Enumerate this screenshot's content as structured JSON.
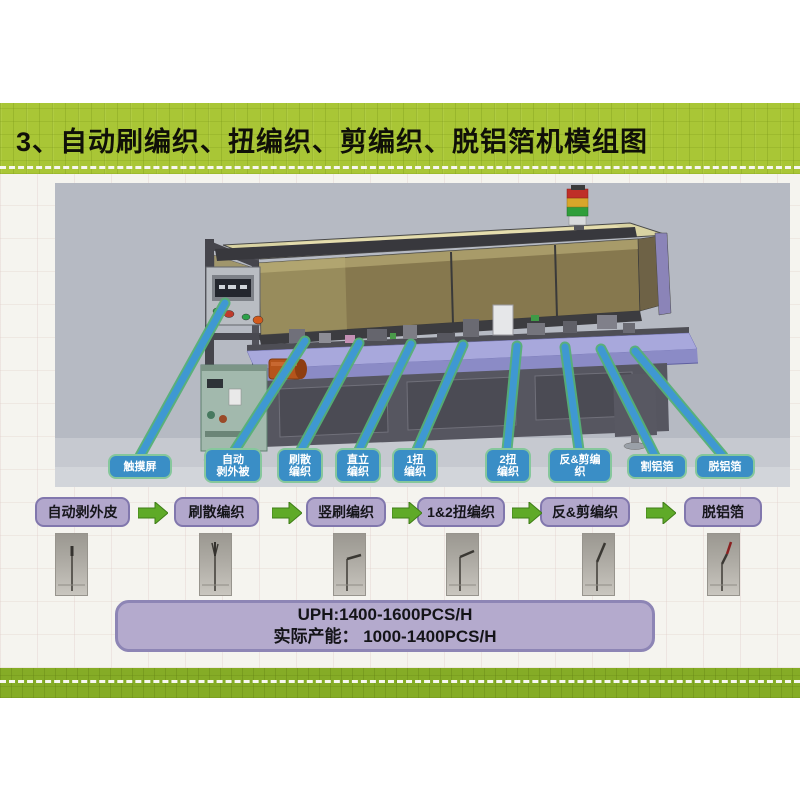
{
  "slide": {
    "title": "3、自动刷编织、扭编织、剪编织、脱铝箔机模组图",
    "colors": {
      "title_bar_green": "#a9c636",
      "footer_band_green": "#85ac26",
      "callout_blue": "#3a8ec6",
      "callout_border_green": "#86c79c",
      "flow_box_purple": "#b2a7cc",
      "flow_box_border": "#8177ad",
      "arrow_green": "#5faa28",
      "capacity_box_purple": "#b4aacd",
      "machine_bg_gray": "#b6bac3"
    }
  },
  "figure": {
    "description": "3D CAD render of automatic braid brushing, twisting, cutting and aluminum-foil stripping machine",
    "callouts": [
      {
        "lines": [
          "触摸屏"
        ]
      },
      {
        "lines": [
          "自动",
          "剥外被"
        ]
      },
      {
        "lines": [
          "刷散",
          "编织"
        ]
      },
      {
        "lines": [
          "直立",
          "编织"
        ]
      },
      {
        "lines": [
          "1扭",
          "编织"
        ]
      },
      {
        "lines": [
          "2扭",
          "编织"
        ]
      },
      {
        "lines": [
          "反&剪编",
          "织"
        ]
      },
      {
        "lines": [
          "割铝箔"
        ]
      },
      {
        "lines": [
          "脱铝箔"
        ]
      }
    ]
  },
  "flow": {
    "steps": [
      {
        "label": "自动剥外皮"
      },
      {
        "label": "刷散编织"
      },
      {
        "label": "竖刷编织"
      },
      {
        "label": "1&2扭编织"
      },
      {
        "label": "反&剪编织"
      },
      {
        "label": "脱铝箔"
      }
    ]
  },
  "capacity": {
    "line1": "UPH:1400-1600PCS/H",
    "line2": "实际产能： 1000-1400PCS/H"
  }
}
